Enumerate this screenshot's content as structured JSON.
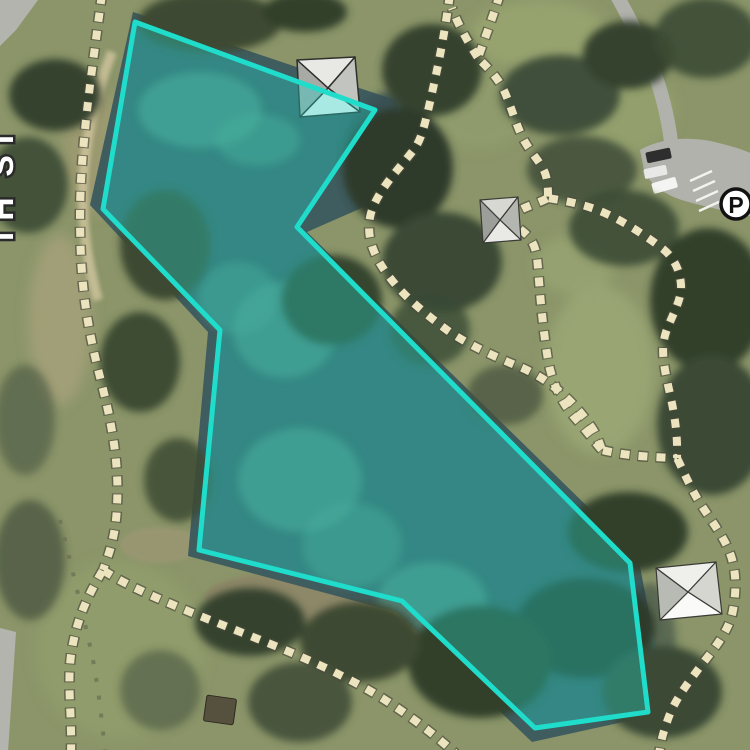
{
  "map": {
    "kind": "aerial-imagery-with-feature-highlight",
    "road_label": "TH ST",
    "parking": {
      "symbol": "P"
    },
    "highlight_polygon": {
      "points": "135,22 375,110 297,227 630,563 648,712 535,728 402,601 199,550 220,330 103,209",
      "stroke": "#1fdccb",
      "fill": "rgba(34,214,199,0.36)",
      "stroke_width": "5"
    },
    "water": {
      "points": "133,12 395,100 425,180 307,232 638,556 668,712 532,742 396,612 188,556 208,332 90,205",
      "color": "#3f5c5e"
    },
    "terrain_colors": {
      "grass": "#8b9569",
      "trees_dark": "#35432e",
      "sand": "#cdc29b",
      "trail_dash": "#ece3bf",
      "trail_casing": "#4a4a3c",
      "road": "#b2b2ac"
    },
    "trails": {
      "left_main": "M 102 -6 C 92 70 80 150 80 215 C 80 290 88 330 102 385 C 114 432 119 470 117 505 C 116 537 108 556 103 570",
      "left_south": "M 103 570 C 88 595 76 620 71 655 C 67 685 72 715 71 752",
      "bottom": "M 103 570 C 125 585 165 602 210 620 C 268 643 330 666 382 698 C 412 717 436 736 456 754",
      "north_descent": "M 450 -6 C 443 45 436 75 430 102 C 423 133 420 142 412 152 C 398 170 378 190 371 213 C 366 232 371 250 383 268 C 398 291 420 310 447 330 C 465 343 495 357 520 367 C 549 379 573 400 592 428 C 598 437 600 445 602 450",
      "north_fork": "M 500 -6 C 492 20 484 40 478 58 C 490 70 500 80 506 95 C 514 115 518 130 525 142 C 534 157 543 165 546 176 C 548 184 548 191 548 198",
      "north_spur": "M 478 58 C 468 42 458 25 452 8",
      "east_upper": "M 548 198 C 560 200 580 203 600 211 C 622 220 645 235 663 249 C 674 258 680 270 681 285 C 682 300 672 315 666 332 C 661 347 663 362 668 385 C 673 407 678 430 677 458",
      "pavilion_link": "M 548 198 C 535 205 518 208 514 216 C 510 224 520 228 528 236 C 536 245 537 256 538 268 C 540 295 543 330 548 360 C 552 383 562 404 577 420 C 585 429 595 442 602 450",
      "east_connector": "M 602 450 C 622 455 645 457 677 458",
      "east_lower": "M 677 458 C 683 470 690 487 700 503 C 712 522 725 538 731 556 C 737 574 736 594 733 610 C 730 628 718 644 703 663 C 688 683 674 700 667 722 C 662 736 660 745 659 756"
    },
    "roads": {
      "access_road": "M 616 -6 C 628 15 640 40 650 62 C 658 80 665 105 669 128 C 671 140 672 150 672 158",
      "parking_lot": "M 640 150 C 660 138 690 136 715 142 C 735 147 752 152 758 158 L 758 218 C 740 214 710 208 685 201 C 665 195 650 185 644 170 Z"
    }
  }
}
